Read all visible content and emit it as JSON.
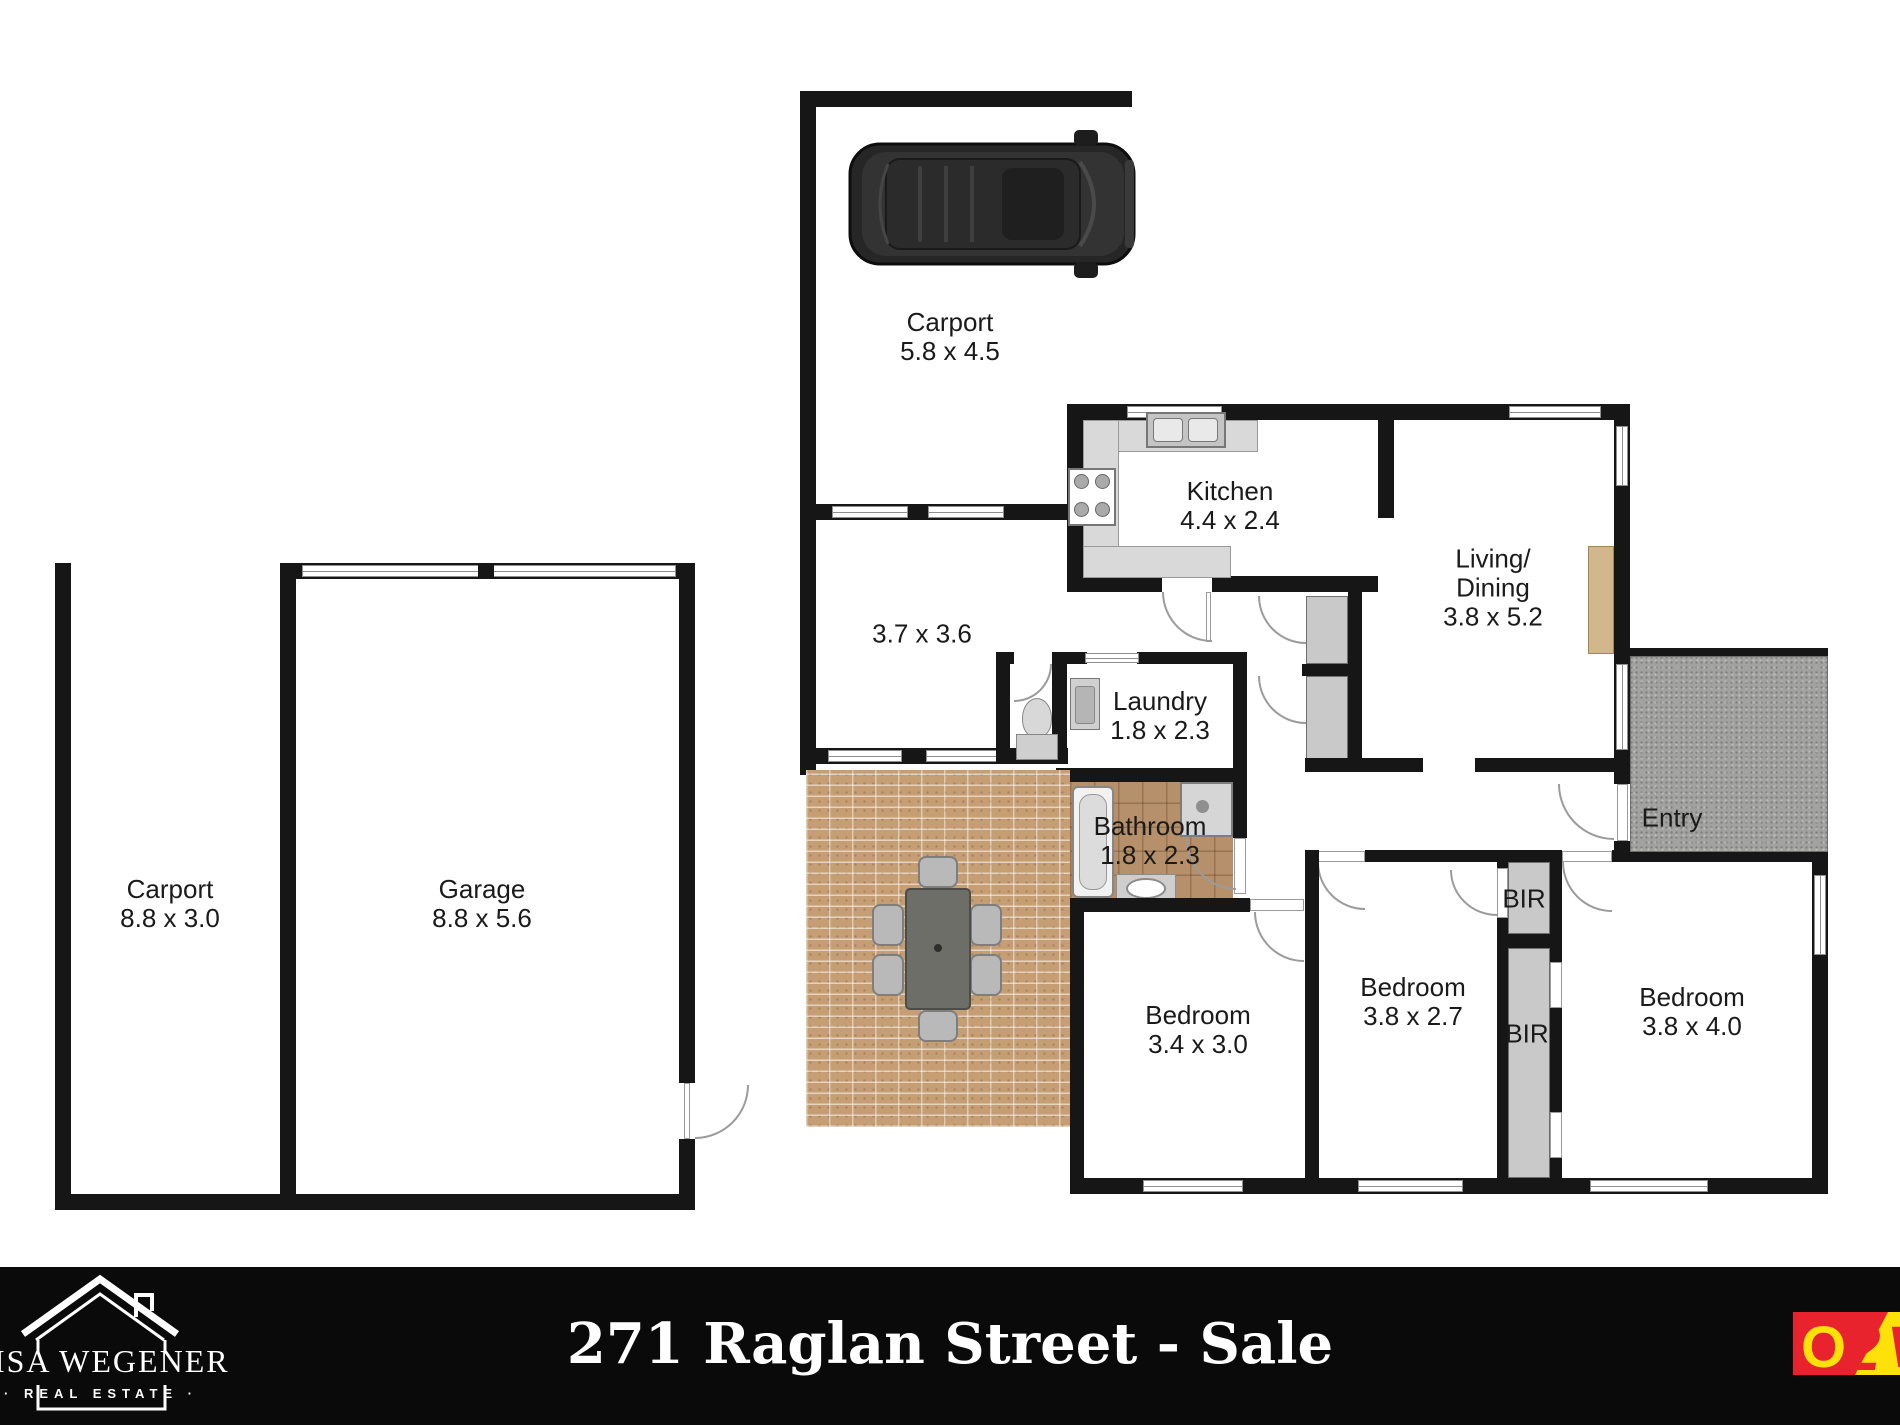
{
  "footer": {
    "title": "271 Raglan Street - Sale"
  },
  "branding": {
    "agency_line1": "LISA WEGENER",
    "agency_line2": "· REAL ESTATE ·",
    "provider_o": "O",
    "provider_2": "2",
    "provider_v": "V"
  },
  "colors": {
    "wall": "#161616",
    "brick_patio": "#c59e74",
    "bathroom_tile": "#b5906b",
    "entry_tile": "#a2a2a0",
    "footer_bg": "#0a0a0a",
    "logo_red": "#e8232e",
    "logo_yellow": "#ffe10a"
  },
  "rooms": [
    {
      "id": "carport-top",
      "lines": [
        "Carport",
        "5.8 x 4.5"
      ]
    },
    {
      "id": "room-3-7",
      "lines": [
        "3.7 x 3.6"
      ]
    },
    {
      "id": "kitchen",
      "lines": [
        "Kitchen",
        "4.4 x 2.4"
      ]
    },
    {
      "id": "living-dining",
      "lines": [
        "Living/",
        "Dining",
        "3.8 x 5.2"
      ]
    },
    {
      "id": "laundry",
      "lines": [
        "Laundry",
        "1.8 x 2.3"
      ]
    },
    {
      "id": "bathroom",
      "lines": [
        "Bathroom",
        "1.8 x 2.3"
      ]
    },
    {
      "id": "entry",
      "lines": [
        "Entry"
      ]
    },
    {
      "id": "bir-upper",
      "lines": [
        "BIR"
      ]
    },
    {
      "id": "bir-lower",
      "lines": [
        "BIR"
      ]
    },
    {
      "id": "bedroom-1",
      "lines": [
        "Bedroom",
        "3.4 x 3.0"
      ]
    },
    {
      "id": "bedroom-2",
      "lines": [
        "Bedroom",
        "3.8 x 2.7"
      ]
    },
    {
      "id": "bedroom-3",
      "lines": [
        "Bedroom",
        "3.8 x 4.0"
      ]
    },
    {
      "id": "carport-left",
      "lines": [
        "Carport",
        "8.8 x 3.0"
      ]
    },
    {
      "id": "garage",
      "lines": [
        "Garage",
        "8.8 x 5.6"
      ]
    }
  ]
}
